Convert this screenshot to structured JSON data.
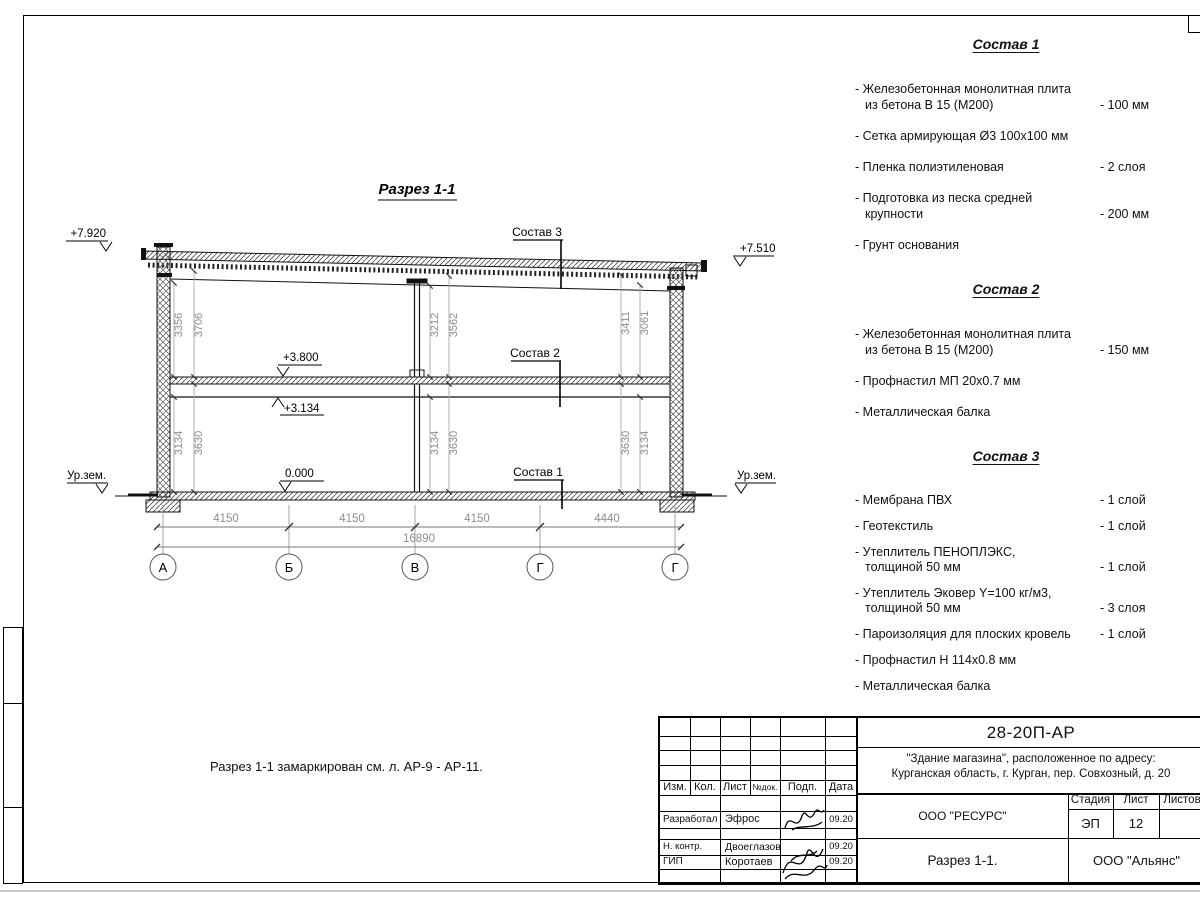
{
  "drawing": {
    "title": "Разрез 1-1",
    "note": "Разрез 1-1 замаркирован см. л. АР-9 - АР-11.",
    "levels": {
      "top_left": "+7.920",
      "top_right": "+7.510",
      "floor2": "+3.800",
      "beam": "+3.134",
      "floor1": "0.000",
      "ground": "Ур.зем."
    },
    "callouts": {
      "c1": "Состав 1",
      "c2": "Состав 2",
      "c3": "Состав 3"
    },
    "grid": [
      "А",
      "Б",
      "В",
      "Г",
      "Г"
    ],
    "hdims": [
      "4150",
      "4150",
      "4150",
      "4440"
    ],
    "total_dim": "16890",
    "vdims": {
      "left_upper": [
        "3356",
        "3706"
      ],
      "mid_upper": [
        "3212",
        "3562"
      ],
      "right_upper": [
        "3411",
        "3061"
      ],
      "left_lower": [
        "3134",
        "3630"
      ],
      "mid_lower": [
        "3134",
        "3630"
      ],
      "right_lower": [
        "3630",
        "3134"
      ]
    }
  },
  "specs": [
    {
      "title": "Состав 1",
      "items": [
        {
          "label": "- Железобетонная  монолитная плита\nиз бетона В 15 (М200)",
          "value": "- 100 мм"
        },
        {
          "label": "- Сетка армирующая Ø3 100х100 мм",
          "value": ""
        },
        {
          "label": "- Пленка полиэтиленовая",
          "value": "-  2 слоя"
        },
        {
          "label": "- Подготовка из песка средней\nкрупности",
          "value": "- 200 мм"
        },
        {
          "label": "- Грунт основания",
          "value": ""
        }
      ]
    },
    {
      "title": "Состав 2",
      "items": [
        {
          "label": "- Железобетонная  монолитная плита\nиз бетона В 15 (М200)",
          "value": "- 150 мм"
        },
        {
          "label": "- Профнастил МП 20х0.7 мм",
          "value": ""
        },
        {
          "label": "- Металлическая балка",
          "value": ""
        }
      ]
    },
    {
      "title": "Состав 3",
      "items": [
        {
          "label": "- Мембрана ПВХ",
          "value": "- 1 слой"
        },
        {
          "label": "- Геотекстиль",
          "value": "- 1 слой"
        },
        {
          "label": "- Утеплитель ПЕНОПЛЭКС,\nтолщиной 50 мм",
          "value": "- 1 слой"
        },
        {
          "label": "- Утеплитель Эковер Y=100 кг/м3,\nтолщиной 50 мм",
          "value": "- 3 слоя"
        },
        {
          "label": "- Пароизоляция для плоских кровель",
          "value": "- 1 слой"
        },
        {
          "label": "- Профнастил Н 114х0.8 мм",
          "value": ""
        },
        {
          "label": "- Металлическая балка",
          "value": ""
        }
      ]
    }
  ],
  "titleblock": {
    "doc_code": "28-20П-АР",
    "object_line1": "\"Здание магазина\", расположенное по адресу:",
    "object_line2": "Курганская область, г. Курган, пер. Совхозный, д. 20",
    "headers": {
      "izm": "Изм.",
      "kol": "Кол.",
      "list": "Лист",
      "ndok": "№док.",
      "podp": "Подп.",
      "data": "Дата"
    },
    "rows": [
      {
        "role": "Разработал",
        "name": "Эфрос",
        "date": "09.20"
      },
      {
        "role": "Н. контр.",
        "name": "Двоеглазов",
        "date": "09.20"
      },
      {
        "role": "ГИП",
        "name": "Коротаев",
        "date": "09.20"
      }
    ],
    "org": "ООО \"РЕСУРС\"",
    "stage_label": "Стадия",
    "sheet_label": "Лист",
    "sheets_label": "Листов",
    "stage": "ЭП",
    "sheet": "12",
    "drawing_name": "Разрез 1-1.",
    "company": "ООО \"Альянс\""
  }
}
